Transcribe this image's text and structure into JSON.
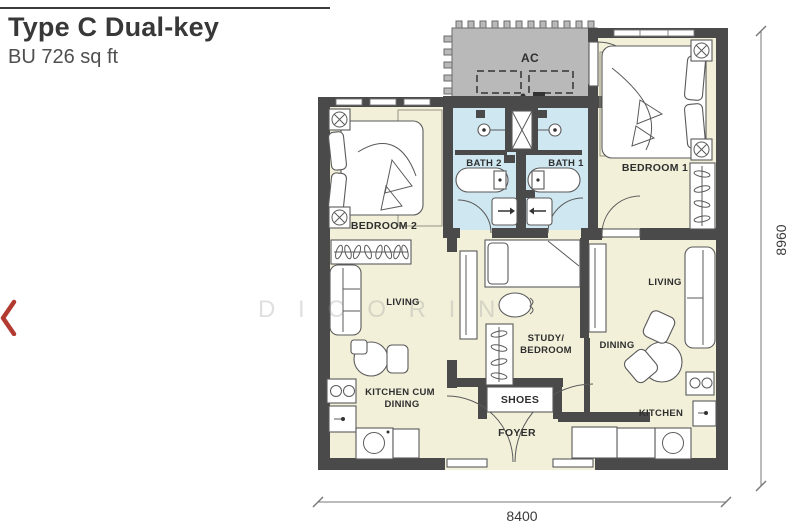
{
  "header": {
    "title": "Type C Dual-key",
    "subtitle": "BU 726 sq ft"
  },
  "carousel": {
    "prev_icon": "chevron-left"
  },
  "watermark": {
    "text": "D I C O R I N"
  },
  "plan": {
    "labels": {
      "ac": "AC",
      "bath2": "BATH 2",
      "bath1": "BATH 1",
      "bedroom2": "BEDROOM 2",
      "bedroom1": "BEDROOM 1",
      "living_left": "LIVING",
      "living_right": "LIVING",
      "study_l1": "STUDY/",
      "study_l2": "BEDROOM",
      "kcd_l1": "KITCHEN CUM",
      "kcd_l2": "DINING",
      "dining": "DINING",
      "kitchen": "KITCHEN",
      "shoes": "SHOES",
      "foyer": "FOYER"
    },
    "dimensions": {
      "bottom": "8400",
      "right": "8960"
    },
    "colors": {
      "wall": "#4a4a4a",
      "room_fill": "#f3f0da",
      "bath_fill": "#cfe7f0",
      "ac_fill": "#b9b9ba",
      "accent_red": "#b23a31",
      "dimension_line": "#777777"
    }
  }
}
